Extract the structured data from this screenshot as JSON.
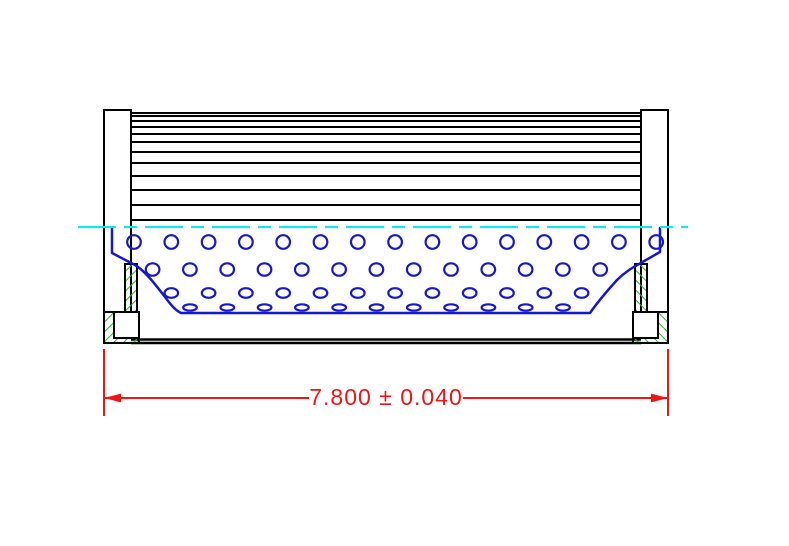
{
  "drawing": {
    "type": "cad-cross-section",
    "subject": "Filter element side-view cross section with pleated media, perforated core tube and end caps",
    "canvas": {
      "width": 789,
      "height": 546,
      "background": "#ffffff"
    },
    "colors": {
      "outline": "#000000",
      "perforation": "#1717cd",
      "centerline": "#1be3ef",
      "hatch": "#2db92d",
      "dimension": "#ee1515",
      "fill": "#ffffff"
    },
    "pleat_block": {
      "x": 131,
      "y": 113,
      "width": 510,
      "height": 107,
      "inner_line_offsets": [
        3,
        8,
        14,
        21,
        29,
        39,
        50,
        63,
        77,
        92
      ]
    },
    "shell_bottom": {
      "x1": 131,
      "x2": 641,
      "y_lines": [
        339.5,
        343
      ]
    },
    "end_caps": {
      "mirror_axis_sum": 772,
      "plate": {
        "x": 104,
        "y": 110,
        "width": 27,
        "height": 202
      },
      "seal_strip": {
        "x": 125,
        "y": 264,
        "width": 12,
        "height": 48
      },
      "foot": {
        "x": 104,
        "y": 312,
        "width": 35,
        "height": 31
      },
      "foot_insert": {
        "x": 114,
        "y": 312,
        "width": 25,
        "height": 26
      }
    },
    "core_boundary_path": "M 112 228 L 112 253 L 135 265 C 145 271 155 284 165 297 C 171 305 175 310 181 313 L 590 313 C 597 303 607 291 617 280 C 625 272 632 268 639 264 L 660 252 L 660 228",
    "perforations": {
      "spacing_x": 37.3,
      "stroke_width": 2.2,
      "rows": [
        {
          "y": 242,
          "start_x": 134,
          "count": 15,
          "rx": 6.8,
          "ry": 6.8
        },
        {
          "y": 269.5,
          "start_x": 152.6,
          "count": 13,
          "rx": 6.8,
          "ry": 6.2
        },
        {
          "y": 293,
          "start_x": 171.3,
          "count": 12,
          "rx": 6.8,
          "ry": 4.8
        },
        {
          "y": 307.5,
          "start_x": 190,
          "count": 11,
          "rx": 6.8,
          "ry": 3.2
        }
      ]
    },
    "centerline": {
      "y": 227,
      "x1": 78,
      "x2": 688,
      "dash": [
        38,
        8,
        13,
        8
      ]
    },
    "dimension": {
      "label": "7.800 ± 0.040",
      "line_y": 398,
      "ext_x_left": 104,
      "ext_x_right": 668,
      "ext_y_top": 349,
      "ext_y_bottom": 416,
      "gap_left": 309,
      "gap_right": 463,
      "text_x": 386,
      "text_y": 405,
      "arrow_length": 17,
      "arrow_half_width": 4.4
    }
  }
}
